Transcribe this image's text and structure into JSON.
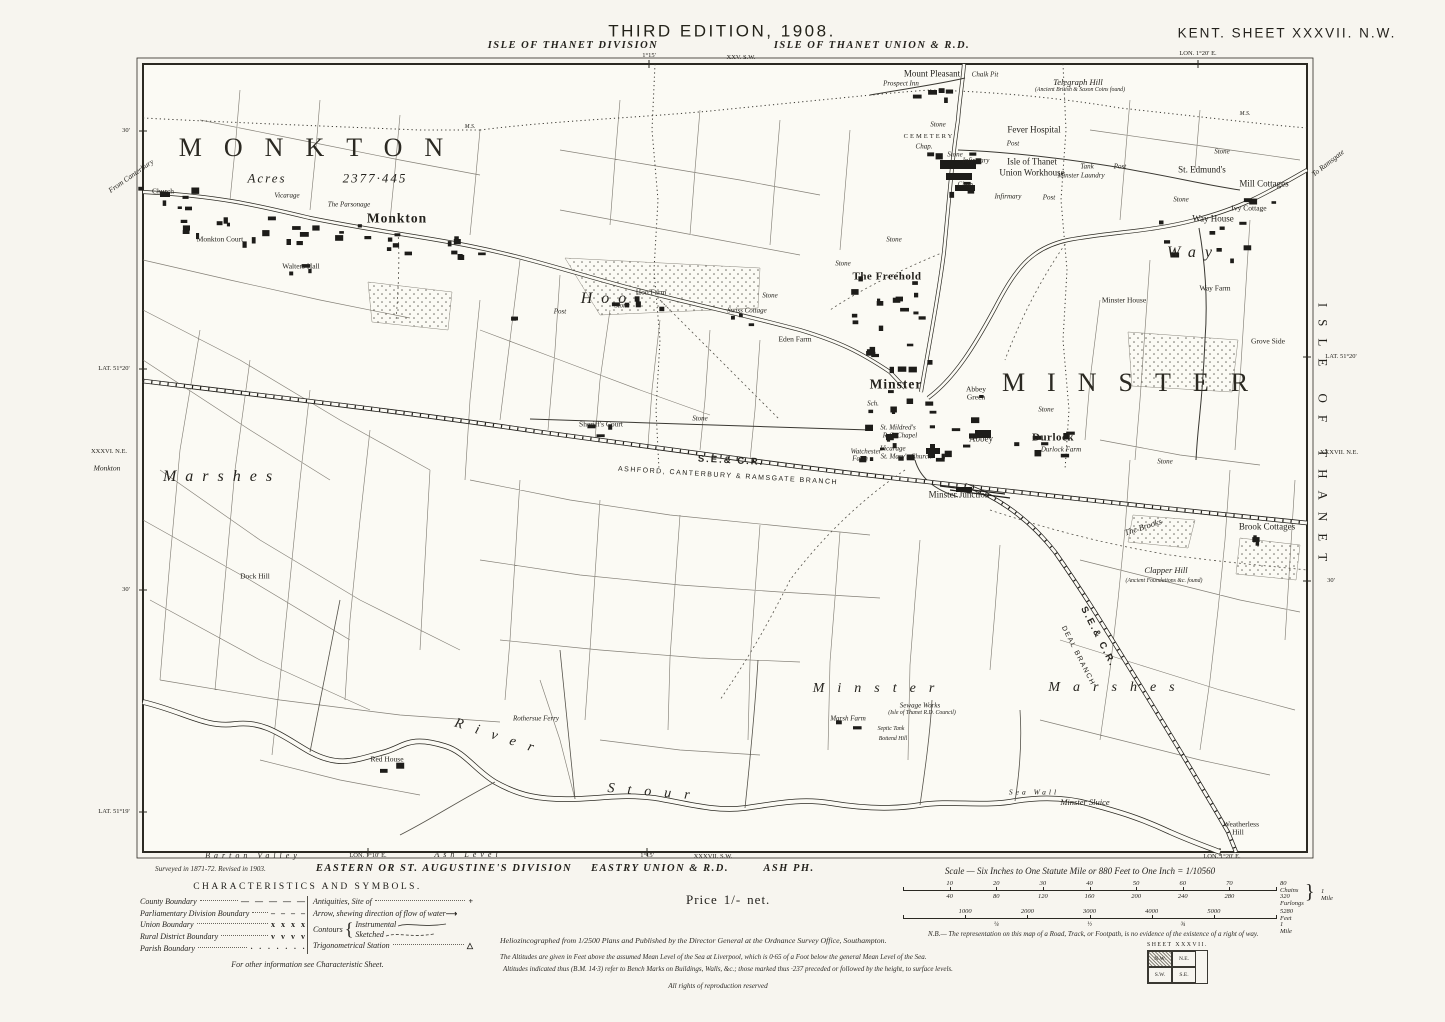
{
  "header": {
    "edition": "THIRD EDITION, 1908.",
    "division_left": "ISLE OF THANET DIVISION",
    "union_right": "ISLE OF THANET UNION & R.D.",
    "sheet_title": "KENT. SHEET XXXVII. N.W."
  },
  "margin_labels": [
    {
      "t": "XXV. S.W.",
      "x": 741,
      "y": 58,
      "c": "MY"
    },
    {
      "t": "1°15'",
      "x": 649,
      "y": 56,
      "c": "MY"
    },
    {
      "t": "LON. 1°20' E.",
      "x": 1198,
      "y": 54,
      "c": "MY"
    },
    {
      "t": "From Canterbury",
      "x": 131,
      "y": 176,
      "c": "MI",
      "r": -35
    },
    {
      "t": "30'",
      "x": 126,
      "y": 131,
      "c": "MY"
    },
    {
      "t": "To Ramsgate",
      "x": 1328,
      "y": 163,
      "c": "MI",
      "r": -38
    },
    {
      "t": "LAT. 51°20'",
      "x": 114,
      "y": 369,
      "c": "MY"
    },
    {
      "t": "XXXVI. N.E.",
      "x": 109,
      "y": 452,
      "c": "MY"
    },
    {
      "t": "Monkton",
      "x": 107,
      "y": 468,
      "c": "MI"
    },
    {
      "t": "LAT. 51°20'",
      "x": 1341,
      "y": 357,
      "c": "MY"
    },
    {
      "t": "XXXVII. N.E.",
      "x": 1339,
      "y": 453,
      "c": "MY"
    },
    {
      "t": "30'",
      "x": 1331,
      "y": 581,
      "c": "MY"
    },
    {
      "t": "30'",
      "x": 126,
      "y": 590,
      "c": "MY"
    },
    {
      "t": "LAT. 51°19'",
      "x": 114,
      "y": 812,
      "c": "MY"
    },
    {
      "t": "ISLE OF THANET",
      "x": 1323,
      "y": 438,
      "c": "MV",
      "r": 90
    },
    {
      "t": "Barton Valley",
      "x": 253,
      "y": 856,
      "c": "MSP"
    },
    {
      "t": "LON. 1°10' E.",
      "x": 368,
      "y": 856,
      "c": "MY"
    },
    {
      "t": "Ash Level",
      "x": 468,
      "y": 855,
      "c": "MSP"
    },
    {
      "t": "EASTERN OR ST. AUGUSTINE'S DIVISION",
      "x": 444,
      "y": 869,
      "c": "MD"
    },
    {
      "t": "1°15'",
      "x": 647,
      "y": 856,
      "c": "MY"
    },
    {
      "t": "XXXVII. S.W.",
      "x": 713,
      "y": 857,
      "c": "MY"
    },
    {
      "t": "EASTRY UNION & R.D.",
      "x": 660,
      "y": 869,
      "c": "MD"
    },
    {
      "t": "ASH PH.",
      "x": 789,
      "y": 869,
      "c": "MD"
    },
    {
      "t": "LON. 1°20' E.",
      "x": 1222,
      "y": 857,
      "c": "MY"
    }
  ],
  "map_labels": [
    {
      "t": "MONKTON",
      "x": 322,
      "y": 148,
      "c": "L"
    },
    {
      "t": "Acres",
      "x": 267,
      "y": 178,
      "c": "A"
    },
    {
      "t": "2377·445",
      "x": 375,
      "y": 178,
      "c": "A"
    },
    {
      "t": "Church",
      "x": 163,
      "y": 191,
      "c": "Y"
    },
    {
      "t": "Monkton Court",
      "x": 220,
      "y": 239,
      "c": "Y"
    },
    {
      "t": "Vicarage",
      "x": 287,
      "y": 196,
      "c": "M"
    },
    {
      "t": "The Parsonage",
      "x": 349,
      "y": 205,
      "c": "M"
    },
    {
      "t": "Monkton",
      "x": 397,
      "y": 218,
      "c": "T"
    },
    {
      "t": "Walters Hall",
      "x": 301,
      "y": 266,
      "c": "Y"
    },
    {
      "t": "Hoo",
      "x": 608,
      "y": 299,
      "c": "P"
    },
    {
      "t": "Hoo Farm",
      "x": 651,
      "y": 292,
      "c": "Y"
    },
    {
      "t": "Swiss Cottage",
      "x": 747,
      "y": 311,
      "c": "M"
    },
    {
      "t": "Eden Farm",
      "x": 795,
      "y": 339,
      "c": "Y"
    },
    {
      "t": "The Freehold",
      "x": 887,
      "y": 277,
      "c": "T2"
    },
    {
      "t": "Sheriff's Court",
      "x": 601,
      "y": 424,
      "c": "Y"
    },
    {
      "t": "Mount Pleasant",
      "x": 932,
      "y": 74,
      "c": "F"
    },
    {
      "t": "Prospect Inn",
      "x": 901,
      "y": 84,
      "c": "M"
    },
    {
      "t": "Chalk Pit",
      "x": 985,
      "y": 75,
      "c": "M"
    },
    {
      "t": "Telegraph Hill",
      "x": 1078,
      "y": 82,
      "c": "I"
    },
    {
      "t": "(Ancient British & Saxon Coins found)",
      "x": 1080,
      "y": 91,
      "c": "M2"
    },
    {
      "t": "CEMETERY",
      "x": 929,
      "y": 137,
      "c": "SC"
    },
    {
      "t": "Chap.",
      "x": 924,
      "y": 147,
      "c": "M"
    },
    {
      "t": "Fever Hospital",
      "x": 1034,
      "y": 130,
      "c": "F"
    },
    {
      "t": "Infirmary",
      "x": 976,
      "y": 161,
      "c": "M"
    },
    {
      "t": "Isle of Thanet",
      "x": 1032,
      "y": 162,
      "c": "F"
    },
    {
      "t": "Union Workhouse",
      "x": 1032,
      "y": 173,
      "c": "F"
    },
    {
      "t": "Chap.",
      "x": 966,
      "y": 185,
      "c": "M"
    },
    {
      "t": "Infirmary",
      "x": 1008,
      "y": 197,
      "c": "M"
    },
    {
      "t": "Minster Laundry",
      "x": 1081,
      "y": 176,
      "c": "M"
    },
    {
      "t": "Tank",
      "x": 1087,
      "y": 167,
      "c": "M"
    },
    {
      "t": "Post",
      "x": 1013,
      "y": 144,
      "c": "M"
    },
    {
      "t": "Post",
      "x": 1120,
      "y": 167,
      "c": "M"
    },
    {
      "t": "Post",
      "x": 1049,
      "y": 198,
      "c": "M"
    },
    {
      "t": "Post",
      "x": 560,
      "y": 312,
      "c": "M"
    },
    {
      "t": "M.S.",
      "x": 470,
      "y": 128,
      "c": "M2"
    },
    {
      "t": "M.S.",
      "x": 1245,
      "y": 115,
      "c": "M2"
    },
    {
      "t": "St. Edmund's",
      "x": 1202,
      "y": 170,
      "c": "F"
    },
    {
      "t": "Mill Cottages",
      "x": 1264,
      "y": 184,
      "c": "F"
    },
    {
      "t": "Ivy Cottage",
      "x": 1249,
      "y": 208,
      "c": "Y"
    },
    {
      "t": "Way House",
      "x": 1213,
      "y": 219,
      "c": "F"
    },
    {
      "t": "Way",
      "x": 1194,
      "y": 253,
      "c": "P"
    },
    {
      "t": "Way Farm",
      "x": 1215,
      "y": 288,
      "c": "Y"
    },
    {
      "t": "Minster House",
      "x": 1124,
      "y": 300,
      "c": "Y"
    },
    {
      "t": "Grove Side",
      "x": 1268,
      "y": 341,
      "c": "Y"
    },
    {
      "t": "MINSTER",
      "x": 1136,
      "y": 383,
      "c": "L"
    },
    {
      "t": "Minster",
      "x": 896,
      "y": 384,
      "c": "T"
    },
    {
      "t": "Abbey",
      "x": 976,
      "y": 389,
      "c": "Y"
    },
    {
      "t": "Green",
      "x": 976,
      "y": 397,
      "c": "Y"
    },
    {
      "t": "Sch.",
      "x": 873,
      "y": 404,
      "c": "M"
    },
    {
      "t": "St. Mildred's",
      "x": 898,
      "y": 428,
      "c": "M"
    },
    {
      "t": "R.C. Chapel",
      "x": 900,
      "y": 436,
      "c": "M"
    },
    {
      "t": "Vicarage",
      "x": 893,
      "y": 449,
      "c": "M"
    },
    {
      "t": "St. Mary's Church",
      "x": 906,
      "y": 457,
      "c": "M"
    },
    {
      "t": "Abbey",
      "x": 981,
      "y": 439,
      "c": "F"
    },
    {
      "t": "Durlock",
      "x": 1053,
      "y": 438,
      "c": "T2"
    },
    {
      "t": "Durlock Farm",
      "x": 1061,
      "y": 450,
      "c": "M"
    },
    {
      "t": "Watchester",
      "x": 866,
      "y": 452,
      "c": "M"
    },
    {
      "t": "Farm",
      "x": 860,
      "y": 459,
      "c": "M"
    },
    {
      "t": "S.E.& C.R.",
      "x": 731,
      "y": 461,
      "c": "R",
      "r": 3
    },
    {
      "t": "ASHFORD, CANTERBURY & RAMSGATE BRANCH",
      "x": 728,
      "y": 476,
      "c": "RB",
      "r": 3.5
    },
    {
      "t": "Minster Junction",
      "x": 959,
      "y": 495,
      "c": "F"
    },
    {
      "t": "S.E.& C.R.",
      "x": 1098,
      "y": 637,
      "c": "R",
      "r": 63
    },
    {
      "t": "DEAL BRANCH",
      "x": 1078,
      "y": 656,
      "c": "RB",
      "r": 63
    },
    {
      "t": "Marshes",
      "x": 222,
      "y": 477,
      "c": "P"
    },
    {
      "t": "Dock Hill",
      "x": 255,
      "y": 576,
      "c": "Y"
    },
    {
      "t": "Minster",
      "x": 880,
      "y": 689,
      "c": "P2"
    },
    {
      "t": "Marshes",
      "x": 1118,
      "y": 688,
      "c": "P2"
    },
    {
      "t": "River",
      "x": 500,
      "y": 738,
      "c": "P2",
      "r": 18
    },
    {
      "t": "Stour",
      "x": 655,
      "y": 793,
      "c": "P2",
      "r": 5
    },
    {
      "t": "Rothersue Ferry",
      "x": 536,
      "y": 719,
      "c": "M"
    },
    {
      "t": "Red House",
      "x": 387,
      "y": 759,
      "c": "Y"
    },
    {
      "t": "Marsh Farm",
      "x": 848,
      "y": 719,
      "c": "M"
    },
    {
      "t": "Sewage Works",
      "x": 920,
      "y": 706,
      "c": "M"
    },
    {
      "t": "(Isle of Thanet R.D. Council)",
      "x": 922,
      "y": 714,
      "c": "M2"
    },
    {
      "t": "Septic Tank",
      "x": 891,
      "y": 730,
      "c": "M2"
    },
    {
      "t": "Bottend Hill",
      "x": 893,
      "y": 740,
      "c": "M2"
    },
    {
      "t": "The Brooks",
      "x": 1143,
      "y": 527,
      "c": "I",
      "r": -18
    },
    {
      "t": "Brook Cottages",
      "x": 1267,
      "y": 527,
      "c": "F"
    },
    {
      "t": "Clapper Hill",
      "x": 1166,
      "y": 570,
      "c": "I"
    },
    {
      "t": "(Ancient Foundations &c. found)",
      "x": 1164,
      "y": 582,
      "c": "M2"
    },
    {
      "t": "Minster Sluice",
      "x": 1085,
      "y": 802,
      "c": "I"
    },
    {
      "t": "Sea Wall",
      "x": 1034,
      "y": 792,
      "c": "S"
    },
    {
      "t": "Weatherless",
      "x": 1241,
      "y": 824,
      "c": "Y"
    },
    {
      "t": "Hill",
      "x": 1238,
      "y": 832,
      "c": "Y"
    },
    {
      "t": "Stone",
      "x": 770,
      "y": 296,
      "c": "M"
    },
    {
      "t": "Stone",
      "x": 622,
      "y": 306,
      "c": "M"
    },
    {
      "t": "Stone",
      "x": 700,
      "y": 419,
      "c": "M"
    },
    {
      "t": "Stone",
      "x": 938,
      "y": 125,
      "c": "M"
    },
    {
      "t": "Stone",
      "x": 955,
      "y": 155,
      "c": "M"
    },
    {
      "t": "Stone",
      "x": 1222,
      "y": 152,
      "c": "M"
    },
    {
      "t": "Stone",
      "x": 1181,
      "y": 200,
      "c": "M"
    },
    {
      "t": "Stone",
      "x": 843,
      "y": 264,
      "c": "M"
    },
    {
      "t": "Stone",
      "x": 1046,
      "y": 410,
      "c": "M"
    },
    {
      "t": "Stone",
      "x": 1165,
      "y": 462,
      "c": "M"
    },
    {
      "t": "Stone",
      "x": 894,
      "y": 240,
      "c": "M"
    }
  ],
  "legend": {
    "title": "CHARACTERISTICS AND SYMBOLS.",
    "rows_left": [
      {
        "label": "County Boundary",
        "sym": "— — — — —"
      },
      {
        "label": "Parliamentary Division Boundary",
        "sym": "– – – –"
      },
      {
        "label": "Union Boundary",
        "sym": "x  x  x  x"
      },
      {
        "label": "Rural District Boundary",
        "sym": "v  v  v  v"
      },
      {
        "label": "Parish Boundary",
        "sym": "· · · · · · ·"
      }
    ],
    "rows_right": {
      "antiquities": "Antiquities, Site of",
      "antiquities_sym": "+",
      "arrow": "Arrow, shewing direction of flow of water",
      "arrow_sym": "⟶",
      "contours": "Contours",
      "contours_sub1": "Instrumental",
      "contours_sub2": "Sketched",
      "trig": "Trigonometrical Station",
      "trig_sym": "△"
    },
    "footer": "For other information see Characteristic Sheet."
  },
  "scale": {
    "title": "Scale — Six Inches to One Statute Mile or 880 Feet to One Inch = 1/10560",
    "chains_top": [
      "10",
      "20",
      "30",
      "40",
      "50",
      "60",
      "70"
    ],
    "chains_top_end": "80 Chains",
    "chains_bottom": [
      "40",
      "80",
      "120",
      "160",
      "200",
      "240",
      "280"
    ],
    "chains_bottom_end": "320 Furlongs",
    "chains_brace": "}",
    "chains_mile": "1 Mile",
    "feet_ticks": [
      "1000",
      "2000",
      "3000",
      "4000",
      "5000"
    ],
    "feet_end": "5280 Feet",
    "feet_fractions": [
      "¼",
      "½",
      "¾"
    ],
    "feet_mile": "1 Mile"
  },
  "price": {
    "label": "Price",
    "value": "1/-",
    "net": "net."
  },
  "footer": {
    "surveyed": "Surveyed in 1871-72. Revised in 1903.",
    "published": "Heliozincographed from 1/2500 Plans and Published by the Director General at the Ordnance Survey Office, Southampton.",
    "nb": "N.B.— The representation on this map of a Road, Track, or Footpath, is no evidence of the existence of a right of way.",
    "altitudes1": "The Altitudes are given in Feet above the assumed Mean Level of the Sea at Liverpool, which is 0·65 of a Foot below the general Mean Level of the Sea.",
    "altitudes2": "Altitudes indicated thus (B.M. 14·3) refer to Bench Marks on Buildings, Walls, &c.; those marked thus ·237 preceded or followed by the height, to surface levels.",
    "rights": "All rights of reproduction reserved"
  },
  "sheet_index": {
    "label": "SHEET  XXXVII.",
    "cells": [
      "N.W.",
      "N.E.",
      "S.W.",
      "S.E."
    ]
  }
}
